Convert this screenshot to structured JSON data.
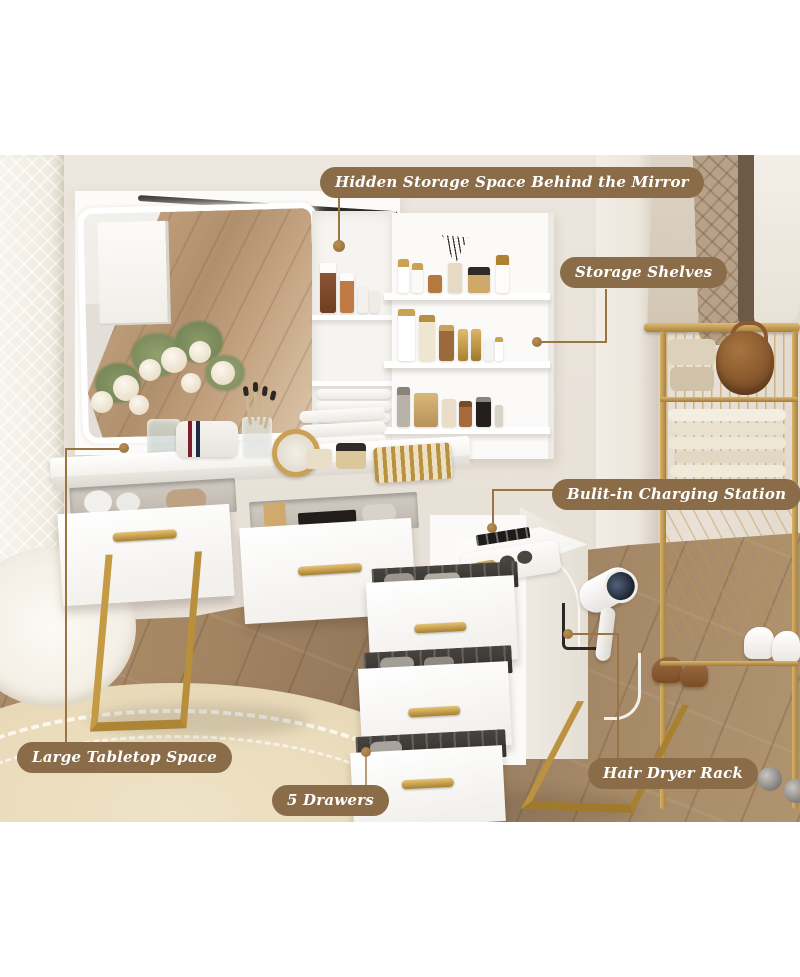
{
  "image": {
    "type": "product feature infographic",
    "subject": "Vanity dressing table set with LED mirror, storage shelves and drawers"
  },
  "style": {
    "label_bg_color": "#8b6c49",
    "label_text_color": "#ffffff",
    "leader_line_color": "#9a7442",
    "gold_accent_color": "#c49a44",
    "wall_color": "#e9e2d9",
    "floor_color": "#a58663"
  },
  "callouts": [
    {
      "id": "hidden-storage",
      "label": "Hidden Storage Space Behind the Mirror"
    },
    {
      "id": "storage-shelves",
      "label": "Storage Shelves"
    },
    {
      "id": "charging-station",
      "label": "Bulit-in Charging Station"
    },
    {
      "id": "large-tabletop",
      "label": "Large Tabletop Space"
    },
    {
      "id": "five-drawers",
      "label": "5 Drawers"
    },
    {
      "id": "hair-dryer-rack",
      "label": "Hair Dryer Rack"
    }
  ],
  "watermark": "NOIR"
}
